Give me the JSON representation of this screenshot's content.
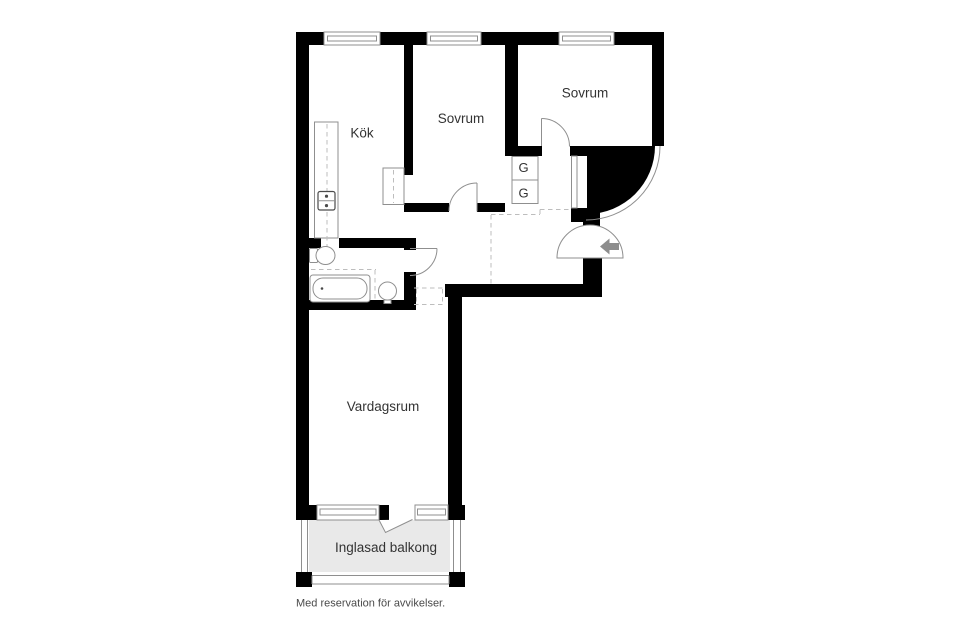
{
  "floor_plan": {
    "rooms": {
      "kitchen": "Kök",
      "bedroom_1": "Sovrum",
      "bedroom_2": "Sovrum",
      "living_room": "Vardagsrum",
      "balcony": "Inglasad balkong"
    },
    "closets": {
      "label": "G"
    },
    "footer_note": "Med reservation för avvikelser.",
    "colors": {
      "background": "#ffffff",
      "wall": "#000000",
      "fixture_line": "#8f8f8f",
      "fixture_dark": "#4a4a4a",
      "dash_line": "#bdbdbd",
      "balcony_fill": "#e9e9e9",
      "arrow": "#8d8d8d",
      "label_text": "#333333",
      "footer_text": "#4a4a4a"
    }
  }
}
